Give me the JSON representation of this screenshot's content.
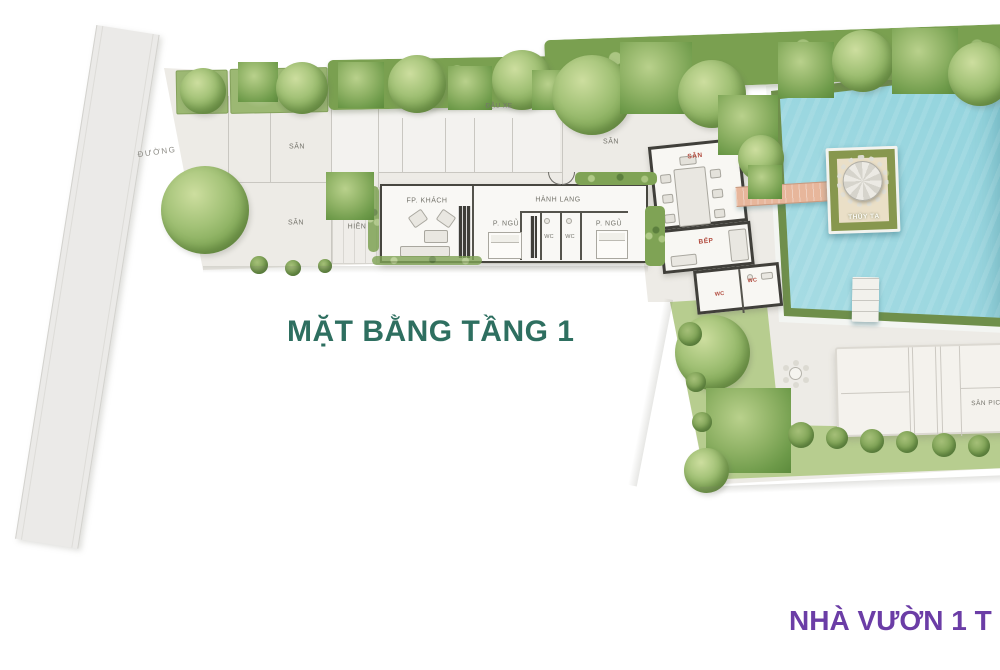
{
  "plan": {
    "title": {
      "text": "MẶT BẰNG TẦNG 1",
      "color": "#2e6f60"
    },
    "caption": {
      "text": "NHÀ VƯỜN 1 T",
      "color": "#6b3da6"
    },
    "road": {
      "label": "ĐƯỜNG"
    },
    "yard": {
      "san_left_upper": "SÂN",
      "san_left_lower": "SÂN",
      "san_top_mid": "SÂN",
      "parking": "ĐẬU XE"
    },
    "house": {
      "living": "FP. KHÁCH",
      "porch": "HIÊN",
      "hall": "HÀNH LANG",
      "bedroom1": "P. NGỦ",
      "bedroom2": "P. NGỦ",
      "wc1": "WC",
      "wc2": "WC"
    },
    "pavilion": {
      "terrace": "SÂN",
      "kitchen": "BẾP",
      "wc1": "WC",
      "wc2": "WC",
      "bridge": "SÂN",
      "bridge_color": "#e7b69b"
    },
    "pool": {
      "island": "THỦY TẠ",
      "water_color": "#8fd2dc"
    },
    "court": {
      "label": "SÂN PICK"
    },
    "colors": {
      "label_red": "#b0473a",
      "label_gray": "#75746c"
    }
  }
}
